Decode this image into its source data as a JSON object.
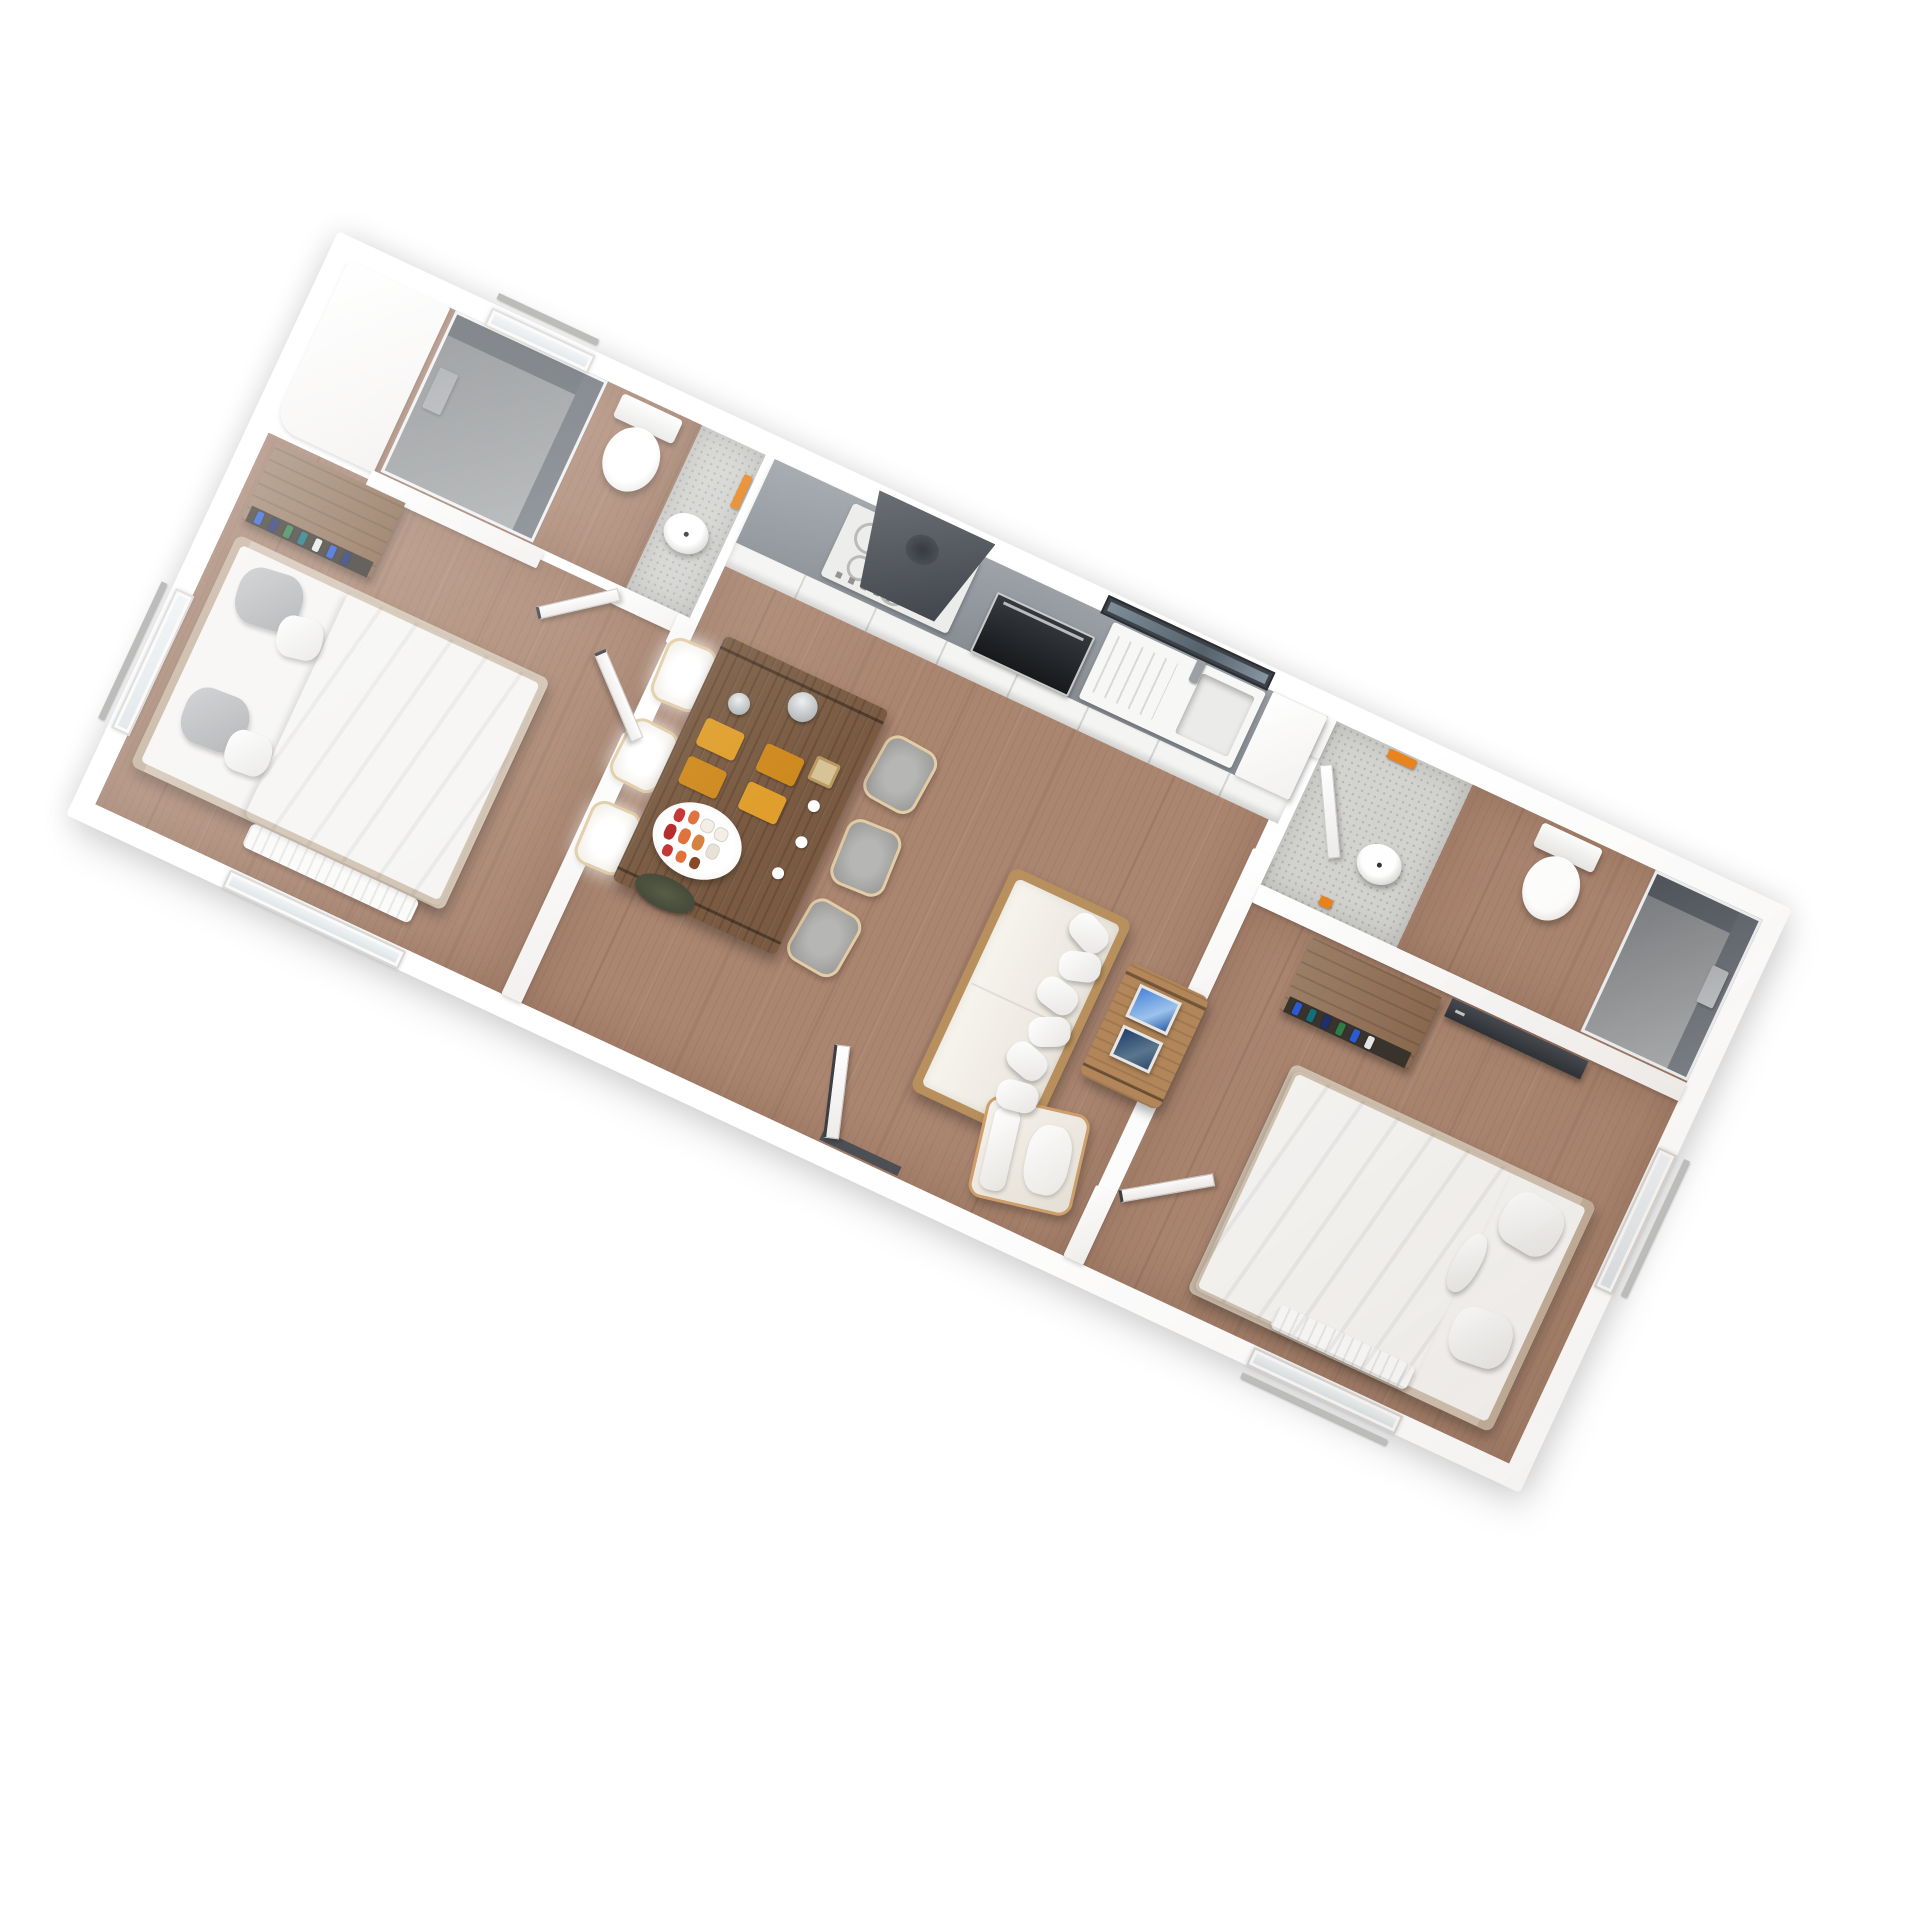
{
  "scene": {
    "type": "3d-floor-plan-render",
    "view": "overhead axonometric, plan rotated ~25 degrees clockwise",
    "background_color": "#ffffff",
    "wall_color": "#ffffff",
    "wood_floor_color": "#aa8570",
    "stone_floor_color": "#d3d3d0",
    "accent_colors": {
      "towels_orange": "#e8831d",
      "worktop_gray": "#8f959b",
      "appliance_dark": "#3c4046",
      "furniture_wood": "#b3875a",
      "dining_table_wood": "#7a5b42",
      "picture_frame_blue": "#4a86d8"
    }
  },
  "rooms": [
    {
      "id": "bathroom-1",
      "name": "Bathroom 1 (top-left)",
      "floor": "wood with stone washstand zone",
      "items": [
        "walk-in shower with smoked glass and dark walls",
        "wall shower unit",
        "toilet with tank against outer wall",
        "round washbasin on stone counter",
        "orange towel",
        "door to bedroom 1",
        "small window"
      ]
    },
    {
      "id": "bedroom-1",
      "name": "Bedroom 1 (left)",
      "floor": "wood",
      "items": [
        "double bed, beige frame, white duvet",
        "2 gray pillows",
        "2 white pillows",
        "open wardrobe with hanging clothes (blue/green/navy)",
        "radiator under window",
        "window in bottom wall",
        "window in left wall",
        "white door standing open"
      ]
    },
    {
      "id": "kitchen",
      "name": "Kitchen run (top of living room)",
      "floor": "wood",
      "items": [
        "gray worktop",
        "white cabinet fronts",
        "4-zone cooktop with control knobs",
        "dark extractor hood",
        "built-in oven with dark glass door",
        "sink with drainer ribs and tap",
        "dark-framed window above sink",
        "tall white cabinet"
      ]
    },
    {
      "id": "living-dining",
      "name": "Living / dining room (center)",
      "floor": "wood",
      "items": [
        "dark wood dining table for six",
        "3 bright cream chairs (window side)",
        "3 gray upholstered chairs",
        "4 orange placemats",
        "oval sushi platter",
        "2 metal teapots",
        "dark serving tray",
        "beige trivet",
        "3 white cups",
        "cream sofa with wood frame and 6 white cushions",
        "wood coffee table with 2 blue picture frames",
        "cream armchair with wood frame",
        "entrance door with dark threshold in bottom wall"
      ]
    },
    {
      "id": "hallway",
      "name": "Hall strip (stone floor)",
      "floor": "stone",
      "items": [
        "doorway from living room with white door"
      ]
    },
    {
      "id": "bathroom-2",
      "name": "Bathroom 2 (right)",
      "floor": "wood with stone washstand zone",
      "items": [
        "round washbasin on stone counter",
        "2 orange towels",
        "toilet with tank against outer wall",
        "corner shower with smoked glass"
      ]
    },
    {
      "id": "bedroom-2",
      "name": "Bedroom 2 (bottom-right)",
      "floor": "wood",
      "items": [
        "double bed, beige frame, white duvet, headboard at right",
        "2 white pillows and white bolster",
        "open wardrobe with hanging clothes",
        "dark sliding-front closet panel",
        "radiator under window",
        "window in bottom wall",
        "window in right wall",
        "white door standing open"
      ]
    }
  ],
  "exterior": [
    "four detached gray window sills protruding outside the outline"
  ]
}
